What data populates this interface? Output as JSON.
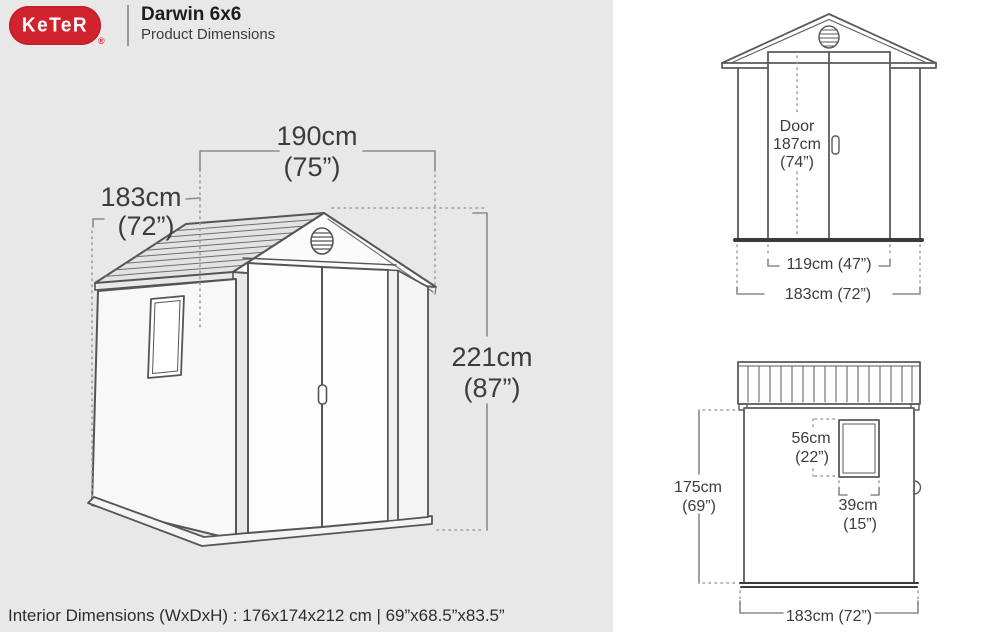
{
  "header": {
    "brand": "KeTeR",
    "registered": "®",
    "title": "Darwin 6x6",
    "subtitle": "Product Dimensions"
  },
  "main_view": {
    "width_cm": "190cm",
    "width_in": "(75”)",
    "depth_cm": "183cm",
    "depth_in": "(72”)",
    "height_cm": "221cm",
    "height_in": "(87”)"
  },
  "front_view": {
    "door_label": "Door",
    "door_height_cm": "187cm",
    "door_height_in": "(74”)",
    "door_width": "119cm (47”)",
    "total_width": "183cm (72”)"
  },
  "side_view": {
    "window_height_cm": "56cm",
    "window_height_in": "(22”)",
    "window_width_cm": "39cm",
    "window_width_in": "(15”)",
    "height_cm": "175cm",
    "height_in": "(69”)",
    "width": "183cm (72”)"
  },
  "footer": {
    "interior_dimensions": "Interior Dimensions (WxDxH) : 176x174x212 cm | 69”x68.5”x83.5”"
  },
  "colors": {
    "brand_red": "#d0232e",
    "panel_gray": "#e8e8e8",
    "line_gray": "#555555"
  }
}
